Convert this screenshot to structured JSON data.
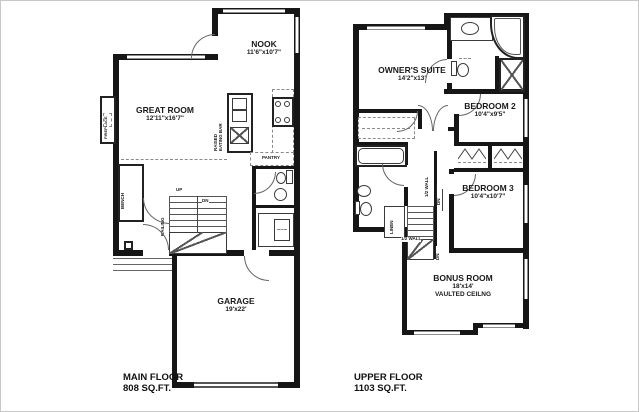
{
  "plans": {
    "main": {
      "caption": {
        "line1": "MAIN FLOOR",
        "line2": "808 SQ.FT."
      },
      "rooms": {
        "nook": {
          "name": "NOOK",
          "dims": "11'6\"x10'7\""
        },
        "great_room": {
          "name": "GREAT ROOM",
          "dims": "12'11\"x16'7\""
        },
        "garage": {
          "name": "GARAGE",
          "dims": "19'x22'"
        }
      },
      "labels": {
        "fireplace": "FIREPLACE",
        "raised": "RAISED",
        "eating_bar": "EATING BAR",
        "pantry": "PANTRY",
        "bench": "BENCH",
        "railing": "RAILING",
        "up": "UP",
        "dn": "DN"
      }
    },
    "upper": {
      "caption": {
        "line1": "UPPER FLOOR",
        "line2": "1103 SQ.FT."
      },
      "rooms": {
        "owners_suite": {
          "name": "OWNER'S SUITE",
          "dims": "14'2\"x13'"
        },
        "bedroom_2": {
          "name": "BEDROOM 2",
          "dims": "10'4\"x9'5\""
        },
        "bedroom_3": {
          "name": "BEDROOM 3",
          "dims": "10'4\"x10'7\""
        },
        "bonus_room": {
          "name": "BONUS ROOM",
          "dims": "18'x14'",
          "note": "VAULTED CEILNG"
        }
      },
      "labels": {
        "linen": "LINEN",
        "half_wall_v": "1/2 WALL",
        "half_wall_h": "1/2 WALL",
        "dn_hall": "DN",
        "dn_lower": "DN"
      }
    }
  },
  "colors": {
    "walls": "#161616",
    "fixture_lines": "#3a3a3a",
    "window": "#8a8a8a",
    "text": "#1a1a1a",
    "background": "#ffffff"
  }
}
